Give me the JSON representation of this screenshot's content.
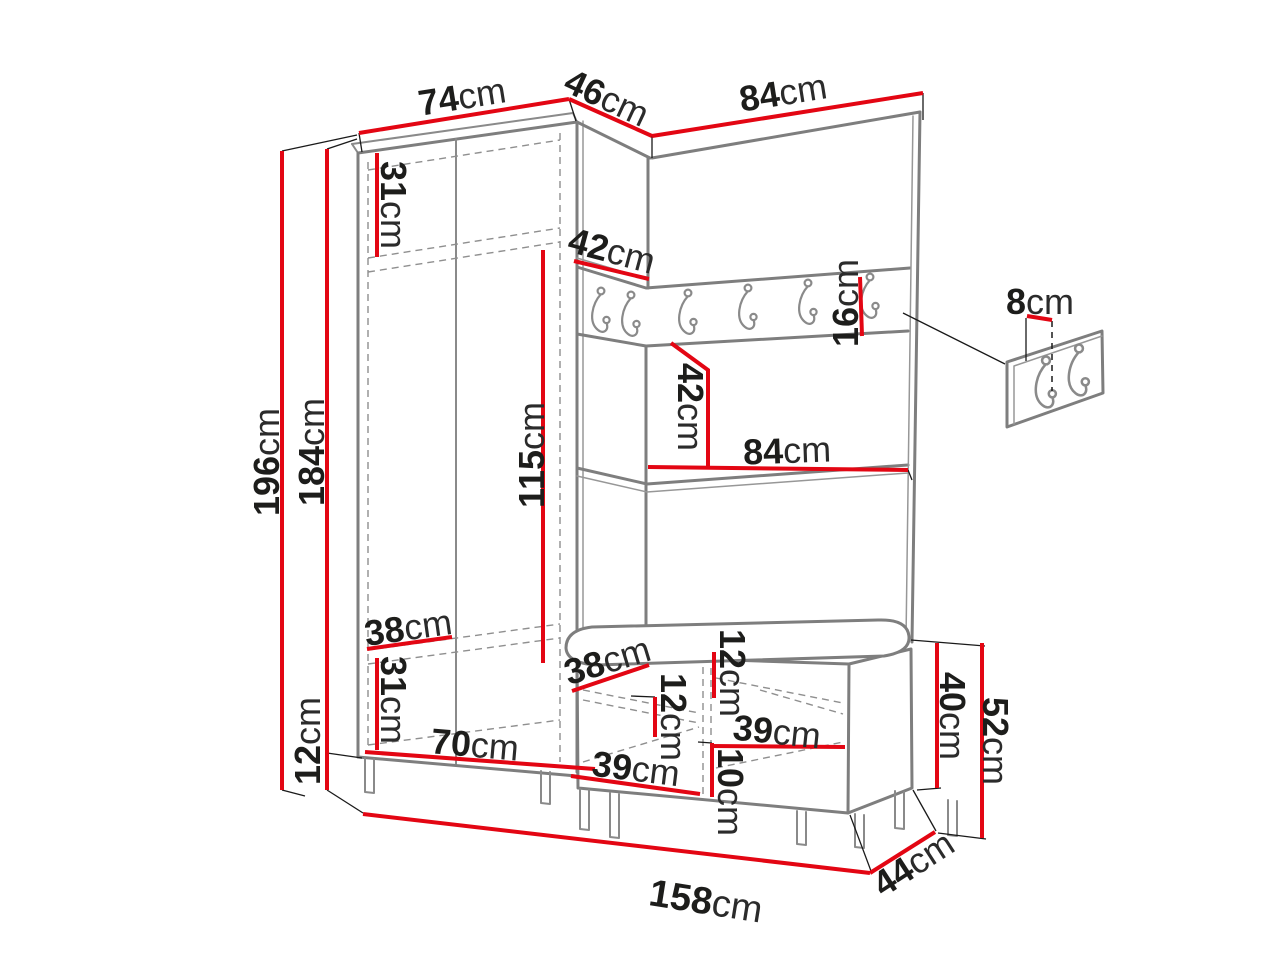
{
  "diagram": {
    "type": "furniture-dimension-drawing",
    "colors": {
      "dimension_line": "#e30613",
      "furniture_outline": "#7e7e7e",
      "label_text": "#1d1d1b",
      "background": "#ffffff"
    },
    "icons": {
      "coat_hook": "j-hook-icon",
      "wall_hook_panel": "two-hook-panel-icon"
    },
    "dims": {
      "top_74": {
        "v": "74",
        "u": "cm"
      },
      "top_46": {
        "v": "46",
        "u": "cm"
      },
      "top_84": {
        "v": "84",
        "u": "cm"
      },
      "height_196": {
        "v": "196",
        "u": "cm"
      },
      "height_184": {
        "v": "184",
        "u": "cm"
      },
      "top_shelf_31": {
        "v": "31",
        "u": "cm"
      },
      "corner_shelf_42": {
        "v": "42",
        "u": "cm"
      },
      "hanging_115": {
        "v": "115",
        "u": "cm"
      },
      "rail_16": {
        "v": "16",
        "u": "cm"
      },
      "panel_42": {
        "v": "42",
        "u": "cm"
      },
      "panel_84": {
        "v": "84",
        "u": "cm"
      },
      "wall_hook_8": {
        "v": "8",
        "u": "cm"
      },
      "wardrobe_38": {
        "v": "38",
        "u": "cm"
      },
      "bottom_shelf_31": {
        "v": "31",
        "u": "cm"
      },
      "legs_12": {
        "v": "12",
        "u": "cm"
      },
      "wardrobe_70": {
        "v": "70",
        "u": "cm"
      },
      "bench_38": {
        "v": "38",
        "u": "cm"
      },
      "bench_top_12": {
        "v": "12",
        "u": "cm"
      },
      "bench_mid_12": {
        "v": "12",
        "u": "cm"
      },
      "bench_39_left": {
        "v": "39",
        "u": "cm"
      },
      "bench_39_right": {
        "v": "39",
        "u": "cm"
      },
      "bench_10": {
        "v": "10",
        "u": "cm"
      },
      "bench_40": {
        "v": "40",
        "u": "cm"
      },
      "bench_52": {
        "v": "52",
        "u": "cm"
      },
      "total_width_158": {
        "v": "158",
        "u": "cm"
      },
      "bench_depth_44": {
        "v": "44",
        "u": "cm"
      }
    }
  }
}
